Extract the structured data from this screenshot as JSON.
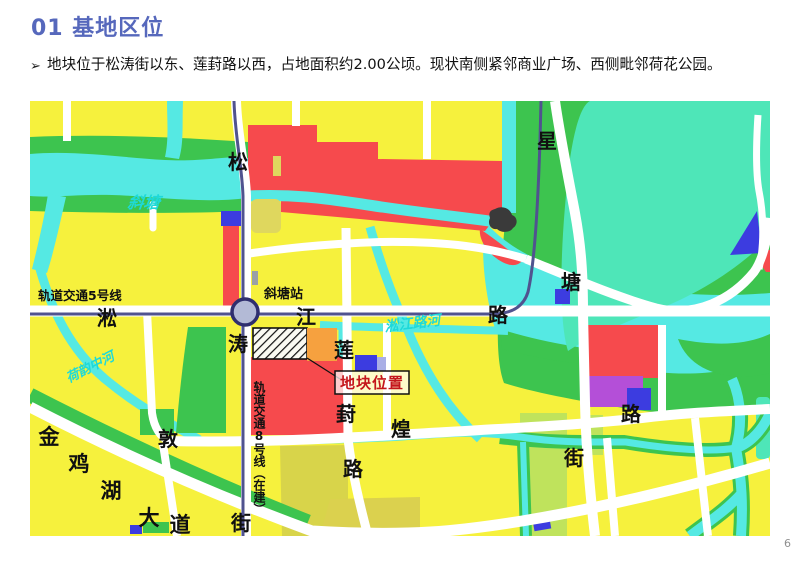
{
  "page": {
    "title": "01 基地区位",
    "bullet": {
      "marker": "➢",
      "text": "地块位于松涛街以东、莲葑路以西，占地面积约2.00公顷。现状南侧紧邻商业广场、西侧毗邻荷花公园。"
    },
    "page_number": "6"
  },
  "map": {
    "streets": {
      "songtao_street": [
        "松",
        "涛",
        "街"
      ],
      "songjiang_road": [
        "淞",
        "江",
        "路"
      ],
      "xingtang_road": [
        "星",
        "塘",
        "路"
      ],
      "lianfeng_road": [
        "莲",
        "葑",
        "路"
      ],
      "dunhuang_street": [
        "敦",
        "煌",
        "街"
      ],
      "jinjihu_avenue": [
        "金",
        "鸡",
        "湖",
        "大",
        "道"
      ]
    },
    "transit": {
      "line5_label": "轨道交通5号线",
      "line8_label": "轨道交通8号线（在建）",
      "station_label": "斜塘站"
    },
    "rivers": {
      "xietang": "斜塘",
      "heyun_middle_river": "荷韵中河",
      "songjiang_road_river": "淞江路河"
    },
    "site": {
      "callout_label": "地块位置"
    },
    "colors": {
      "land_yellow": "#F6F13D",
      "commercial_red": "#F64A4D",
      "park_green": "#3DC44F",
      "water_cyan": "#55E9E3",
      "lake_teal": "#4EE6B8",
      "village_olive": "#DFD75E",
      "lime_green": "#BFE35C",
      "site_orange": "#F6A13F",
      "facility_blue": "#3C3CE0",
      "facility_purple": "#B44FD8",
      "road_white": "#FFFFFF",
      "metro_line": "#50538F",
      "callout_text_red": "#C4161C",
      "title_blue": "#5668BC"
    }
  }
}
